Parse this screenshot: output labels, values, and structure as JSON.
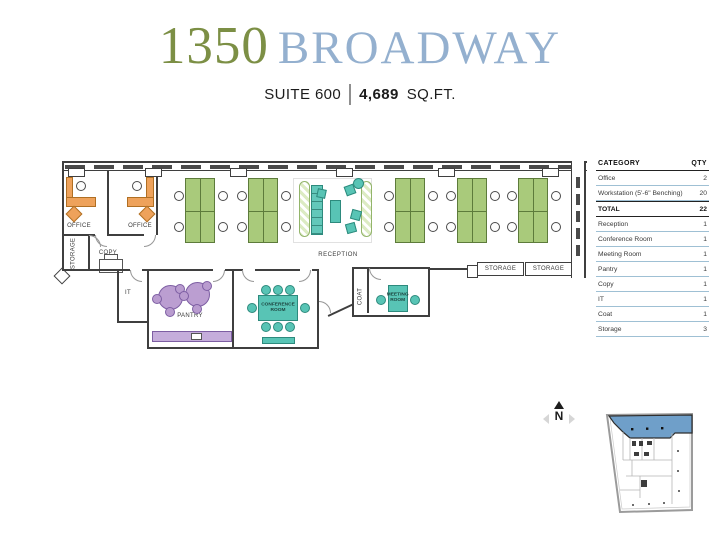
{
  "header": {
    "number": "1350",
    "name": "BROADWAY",
    "suite": "SUITE 600",
    "area_value": "4,689",
    "area_unit": "SQ.FT."
  },
  "summary_table": {
    "headers": [
      "CATEGORY",
      "QTY"
    ],
    "rows": [
      {
        "label": "Office",
        "qty": "2"
      },
      {
        "label": "Workstation (5'-6\" Benching)",
        "qty": "20"
      },
      {
        "label": "TOTAL",
        "qty": "22",
        "bold": true
      },
      {
        "label": "Reception",
        "qty": "1"
      },
      {
        "label": "Conference Room",
        "qty": "1"
      },
      {
        "label": "Meeting Room",
        "qty": "1"
      },
      {
        "label": "Pantry",
        "qty": "1"
      },
      {
        "label": "Copy",
        "qty": "1"
      },
      {
        "label": "IT",
        "qty": "1"
      },
      {
        "label": "Coat",
        "qty": "1"
      },
      {
        "label": "Storage",
        "qty": "3"
      }
    ]
  },
  "plan": {
    "rooms": {
      "office_left": "OFFICE",
      "office_right": "OFFICE",
      "storage_left": "STORAGE",
      "copy": "COPY",
      "it": "IT",
      "pantry": "PANTRY",
      "conference": "CONFERENCE ROOM",
      "reception": "RECEPTION",
      "coat": "COAT",
      "meeting": "MEETING ROOM",
      "storage_a": "STORAGE",
      "storage_b": "STORAGE"
    }
  },
  "compass": {
    "label": "N"
  },
  "colors": {
    "title_number": "#7c8f45",
    "title_name": "#94b0cf",
    "desk_orange": "#eea25b",
    "bench_green": "#a9ca7b",
    "accent_teal": "#58c4b5",
    "accent_purple": "#bb9ed1",
    "key_highlight": "#6f9fc9",
    "table_line": "#9fc0d4"
  }
}
